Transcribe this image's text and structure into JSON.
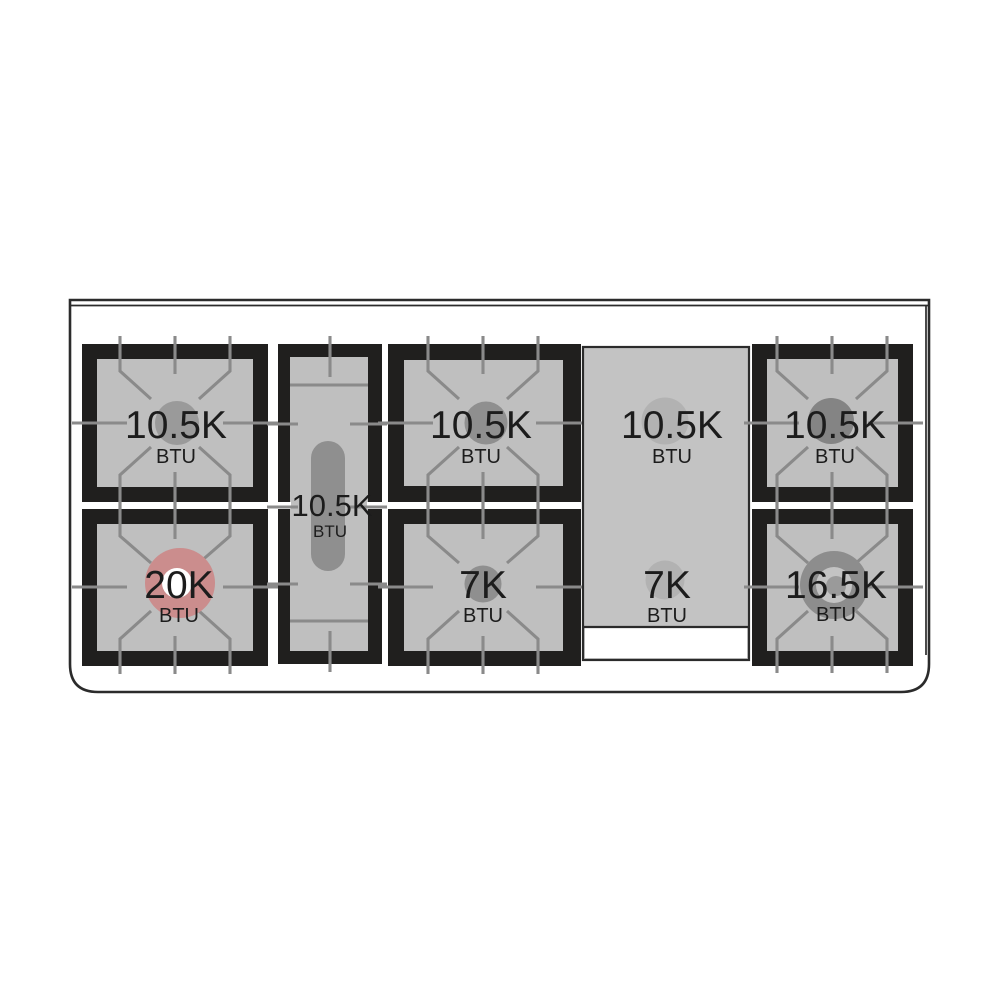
{
  "diagram": {
    "kind": "range-cooktop-burner-layout-top-view",
    "rows": 2,
    "burner_count": 9
  },
  "burners": {
    "left_rear": {
      "value": "10.5K",
      "unit": "BTU"
    },
    "left_front": {
      "value": "20K",
      "unit": "BTU",
      "highlighted": true
    },
    "center_oval": {
      "value": "10.5K",
      "unit": "BTU"
    },
    "middle_rear": {
      "value": "10.5K",
      "unit": "BTU"
    },
    "middle_front": {
      "value": "7K",
      "unit": "BTU"
    },
    "griddle_rear": {
      "value": "10.5K",
      "unit": "BTU"
    },
    "griddle_front": {
      "value": "7K",
      "unit": "BTU"
    },
    "right_rear": {
      "value": "10.5K",
      "unit": "BTU"
    },
    "right_front": {
      "value": "16.5K",
      "unit": "BTU"
    }
  },
  "colors": {
    "outline": "#2b2b2b",
    "frame": "#201f1e",
    "panel": "#bfbfbf",
    "griddle": "#c3c3c3",
    "grate": "#8a8a8a",
    "burner": "#9a9a9a",
    "burner_mid": "#8f8f8f",
    "burner_dark": "#848484",
    "burner_soft": "#b2b2b2",
    "burner_ring": "#8d8d8d",
    "accent_pink": "#cb8d8d",
    "text": "#1c1c1c",
    "background": "#ffffff"
  }
}
